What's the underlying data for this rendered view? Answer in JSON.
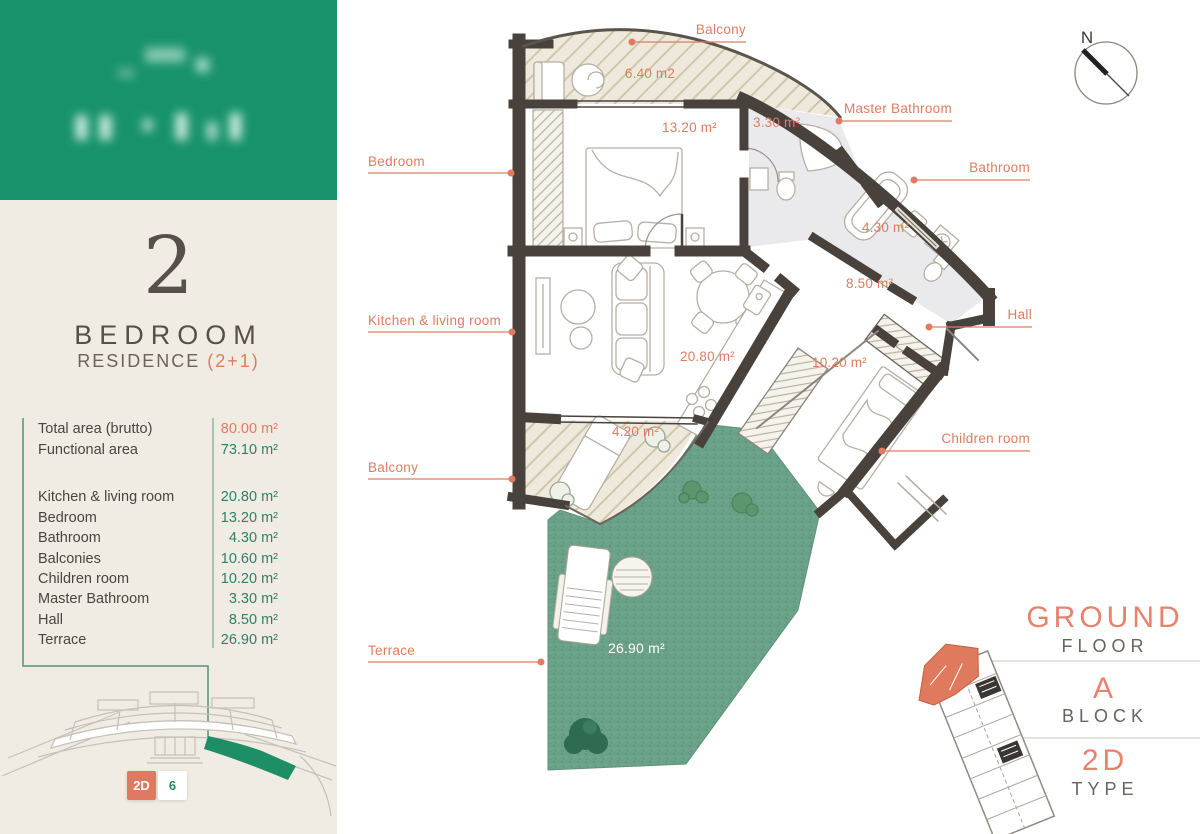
{
  "colors": {
    "brand_green": "#18926b",
    "accent_orange": "#df7c60",
    "value_green": "#2f8166",
    "wall": "#49423c",
    "sidebar_bg": "#f0ebe3",
    "terrace_green": "#6aa189"
  },
  "sidebar": {
    "unit_number": "2",
    "unit_type": "BEDROOM",
    "residence": "RESIDENCE ",
    "residence_suffix": "(2+1)",
    "summary": [
      {
        "label": "Total area (brutto)",
        "value": "80.00 m²"
      },
      {
        "label": "Functional area",
        "value": "73.10 m²"
      }
    ],
    "rooms": [
      {
        "label": "Kitchen & living room",
        "value": "20.80 m²"
      },
      {
        "label": "Bedroom",
        "value": "13.20 m²"
      },
      {
        "label": "Bathroom",
        "value": "4.30 m²"
      },
      {
        "label": "Balconies",
        "value": "10.60 m²"
      },
      {
        "label": "Children room",
        "value": "10.20 m²"
      },
      {
        "label": "Master Bathroom",
        "value": "3.30 m²"
      },
      {
        "label": "Hall",
        "value": "8.50 m²"
      },
      {
        "label": "Terrace",
        "value": "26.90 m²"
      }
    ],
    "type_badge": "2D",
    "unit_badge": "6"
  },
  "floorplan": {
    "compass": "N",
    "labels": {
      "balcony_top": "Balcony",
      "master_bathroom": "Master Bathroom",
      "bathroom": "Bathroom",
      "hall": "Hall",
      "bedroom": "Bedroom",
      "kitchen_living": "Kitchen & living room",
      "balcony_low": "Balcony",
      "terrace": "Terrace",
      "children_room": "Children room"
    },
    "areas": {
      "balcony_top": "6.40 m2",
      "bedroom": "13.20 m²",
      "master_bathroom": "3.30 m²",
      "bathroom": "4.30 m²",
      "hall": "8.50 m²",
      "kitchen_living": "20.80 m²",
      "children_room": "10.20 m²",
      "balcony_low": "4.20 m²",
      "terrace": "26.90 m²"
    }
  },
  "info_panel": {
    "floor_value": "GROUND",
    "floor_label": "FLOOR",
    "block_value": "A",
    "block_label": "BLOCK",
    "type_value": "2D",
    "type_label": "TYPE"
  }
}
